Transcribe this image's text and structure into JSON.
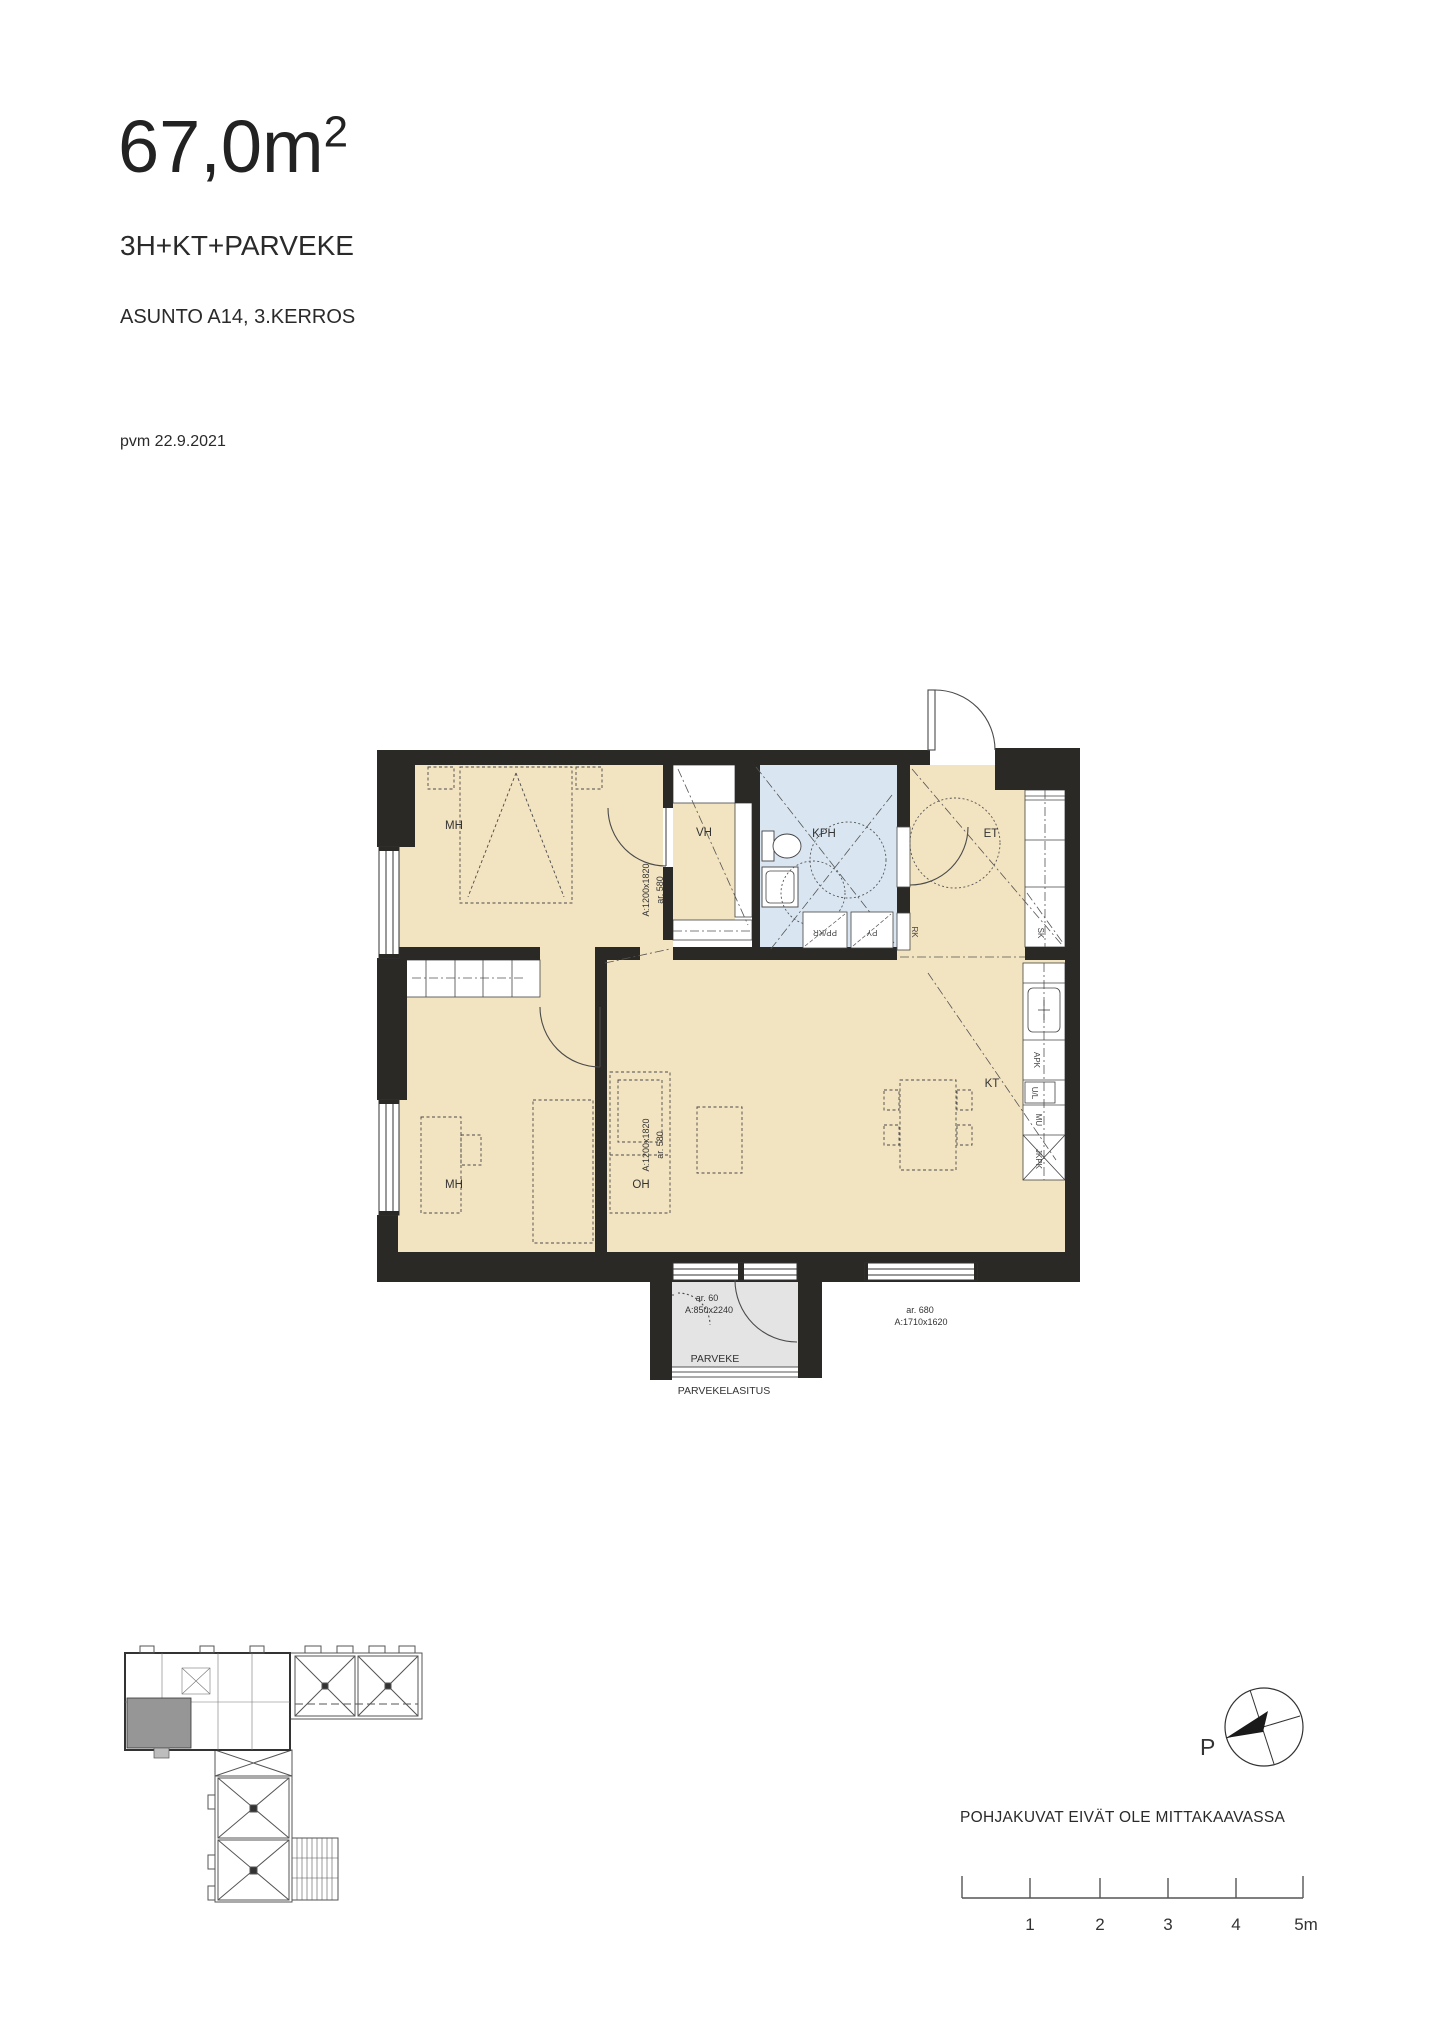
{
  "header": {
    "area_value": "67,0m",
    "area_exponent": "2",
    "apartment_type": "3H+KT+PARVEKE",
    "apartment_info": "ASUNTO A14, 3.KERROS",
    "date": "pvm 22.9.2021"
  },
  "plan": {
    "rooms": {
      "bedroom1": "MH",
      "closet_hall": "VH",
      "bathroom": "KPH",
      "entry": "ET",
      "bedroom2": "MH",
      "living": "OH",
      "kitchen": "KT",
      "balcony": "PARVEKE"
    },
    "fixtures": {
      "entry_closet": "SK",
      "dishwasher": "APK",
      "oven": "U/L",
      "microwave": "MU",
      "fridge": "JKPK",
      "washer": "PP/KR",
      "dryer": "PY",
      "electrical": "RK"
    },
    "dims": {
      "left_window": "A:1200x1820",
      "left_window_ar": "ar. 580",
      "balcony_ar": "ar. 60",
      "balcony_door": "A:850x2240",
      "glazing_label": "PARVEKELASITUS",
      "bottom_window_ar": "ar. 680",
      "bottom_window": "A:1710x1620"
    }
  },
  "footer": {
    "north_label": "P",
    "disclaimer": "POHJAKUVAT EIVÄT OLE MITTAKAAVASSA",
    "scale": [
      "1",
      "2",
      "3",
      "4",
      "5m"
    ]
  },
  "colors": {
    "floor": "#f2e3c1",
    "wet_room": "#d9e6f2",
    "wall": "#2b2926",
    "balcony": "#e4e4e4",
    "highlight_unit": "#969696"
  }
}
